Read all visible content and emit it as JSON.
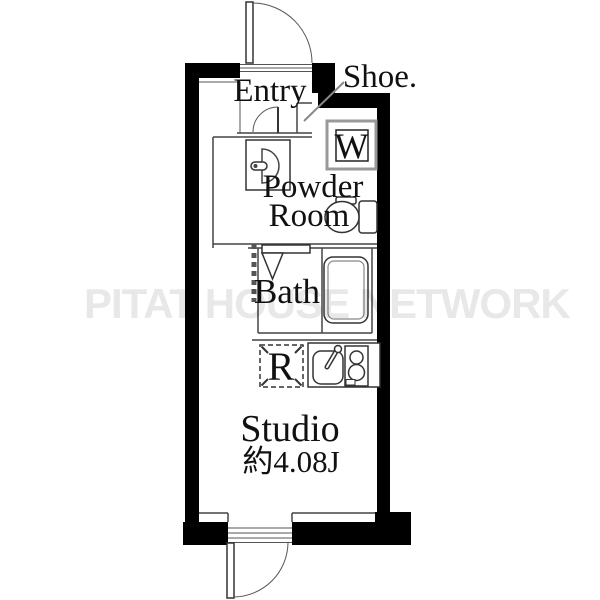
{
  "plan": {
    "labels": {
      "entry": "Entry",
      "shoe": "Shoe.",
      "washer": "W",
      "powder1": "Powder",
      "powder2": "Room",
      "bath": "Bath",
      "fridge": "R",
      "studio": "Studio",
      "area": "約4.08J"
    },
    "watermark": "PITAT HOUSE NETWORK",
    "colors": {
      "wall": "#000000",
      "line": "#444444",
      "fixture": "#333333",
      "text": "#111111",
      "watermark": "#e8e8e8"
    }
  }
}
